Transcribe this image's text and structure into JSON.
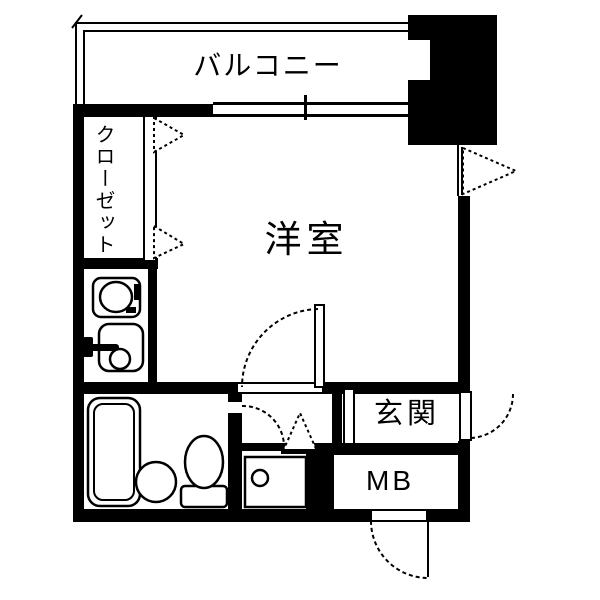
{
  "meta": {
    "type": "floor-plan",
    "style": "japanese-real-estate-diagram"
  },
  "colors": {
    "wall": "#000000",
    "background": "#ffffff",
    "line": "#000000"
  },
  "labels": {
    "balcony": "バルコニー",
    "closet": "クローゼット",
    "western_room": "洋室",
    "entrance": "玄関",
    "meter_box": "MB"
  },
  "fixtures": [
    "bathtub",
    "wash-basin",
    "toilet",
    "stove-burner",
    "kitchen-sink",
    "faucet",
    "washing-machine-pan",
    "sliding-window",
    "outward-opening-window",
    "closet-folding-doors",
    "room-door-swing",
    "bathroom-door-swing",
    "entrance-door-swing",
    "meter-box-door-swing",
    "entrance-step",
    "pillar-block"
  ]
}
